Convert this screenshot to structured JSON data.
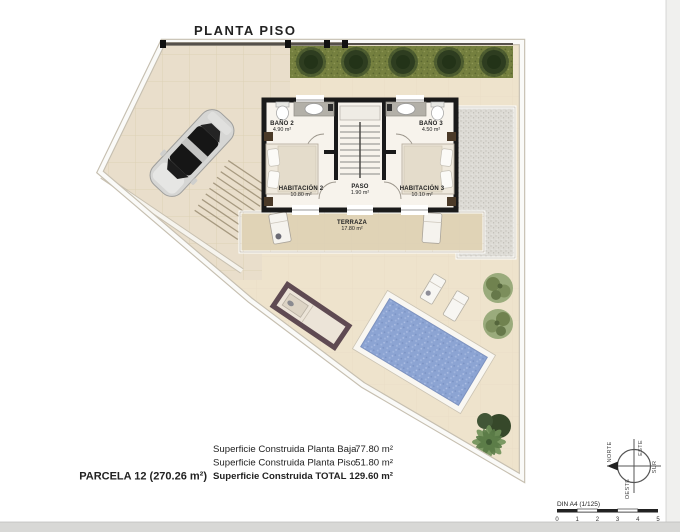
{
  "page": {
    "title": "PLANTA PISO"
  },
  "rooms": {
    "bano2": {
      "name": "BAÑO 2",
      "area": "4.90 m²"
    },
    "bano3": {
      "name": "BAÑO 3",
      "area": "4.50 m²"
    },
    "habitacion2": {
      "name": "HABITACIÓN 2",
      "area": "10.80 m²"
    },
    "paso": {
      "name": "PASO",
      "area": "1.90 m²"
    },
    "habitacion3": {
      "name": "HABITACIÓN 3",
      "area": "10.10 m²"
    },
    "terraza": {
      "name": "TERRAZA",
      "area": "17.80 m²"
    }
  },
  "summary": {
    "parcel": "PARCELA 12 (270.26 m²)",
    "rows": [
      {
        "label": "Superficie Construida Planta Baja",
        "value": "77.80 m²"
      },
      {
        "label": "Superficie Construida Planta Piso",
        "value": "51.80 m²"
      },
      {
        "label": "Superficie Construida TOTAL",
        "value": "129.60 m²"
      }
    ]
  },
  "compass": {
    "north": "NORTE",
    "east": "ESTE",
    "south": "SUR",
    "west": "OESTE"
  },
  "scalebar": {
    "label": "DIN A4 (1/125)",
    "ticks": [
      "0",
      "1",
      "2",
      "3",
      "4",
      "5"
    ]
  },
  "colors": {
    "paving": "#e9decb",
    "garden": "#eee3cc",
    "hedge_grass": "#75803f",
    "pool_water": "#8ca4d3",
    "wall": "#1a1a1a",
    "gravel": "#dddbd5"
  }
}
